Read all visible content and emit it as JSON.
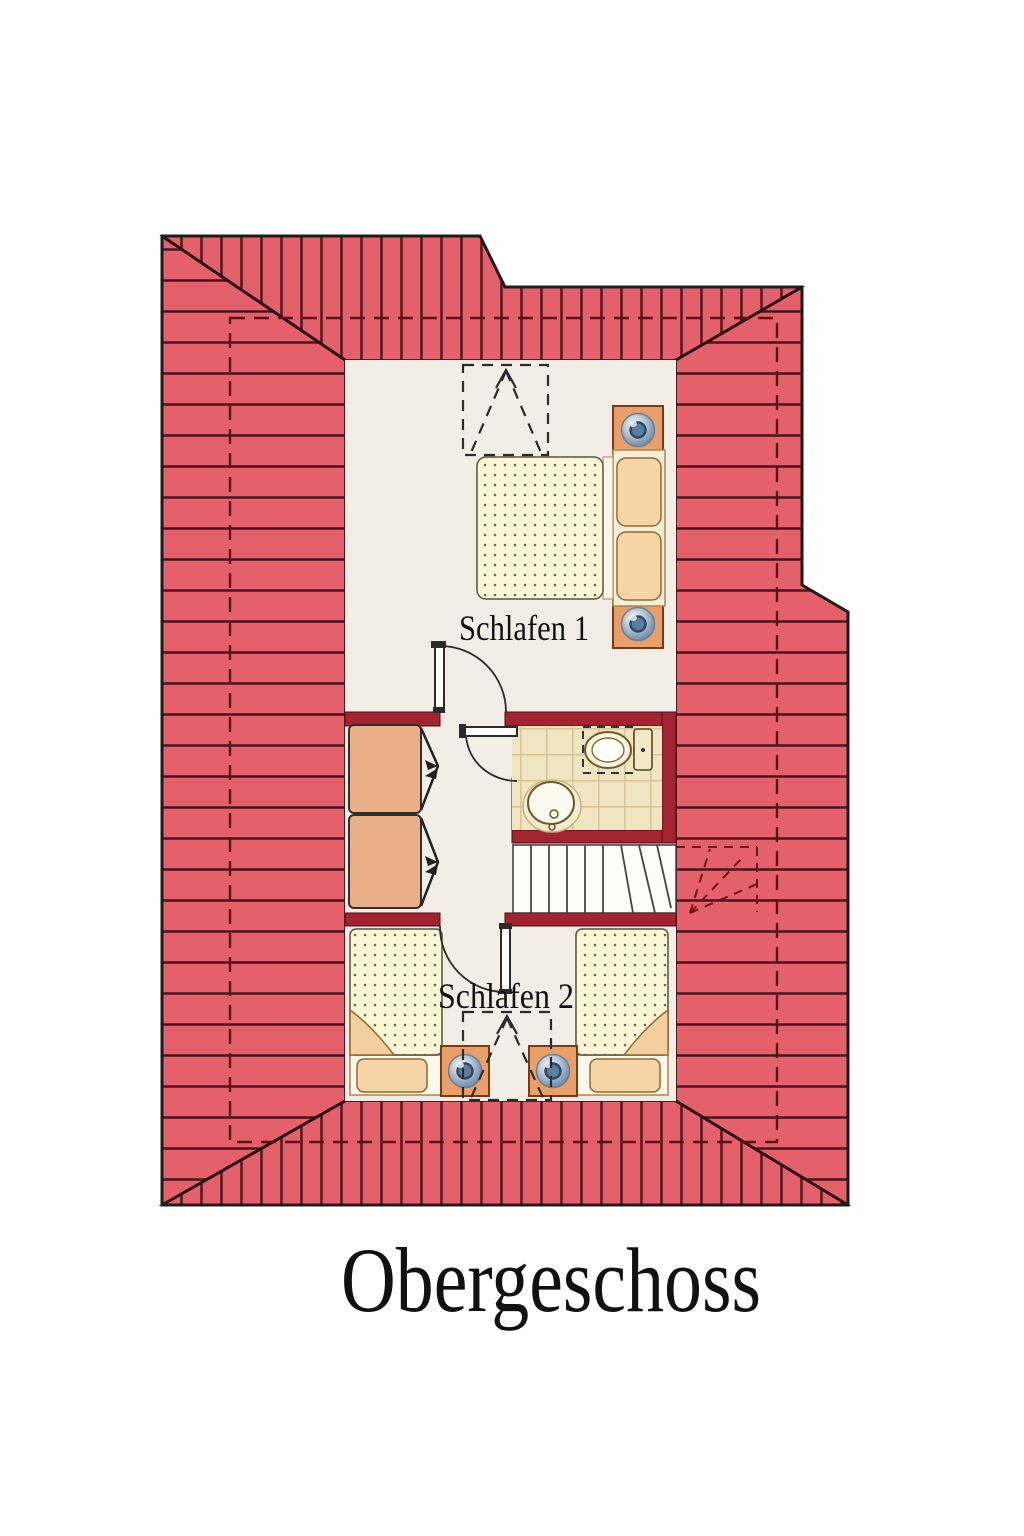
{
  "title": "Obergeschoss",
  "rooms": {
    "bedroom1": "Schlafen 1",
    "bedroom2": "Schlafen 2"
  },
  "colors": {
    "roof": "#e4606a",
    "roof_line": "#47151a",
    "hip_line": "#2a1013",
    "outline": "#1c1c1c",
    "wall": "#a32430",
    "floor": "#f2eee5",
    "bath_tile": "#f0e5c0",
    "tile_line": "#d7c494",
    "wood": "#e9b088",
    "bed_linen": "#faf6d6",
    "pillow": "#f5d4a6",
    "frame_wood": "#f7eed6",
    "lamp_blue": "#7d97b0",
    "stair_tread": "#fcfcf9",
    "dashed_guide": "#5e1216"
  }
}
